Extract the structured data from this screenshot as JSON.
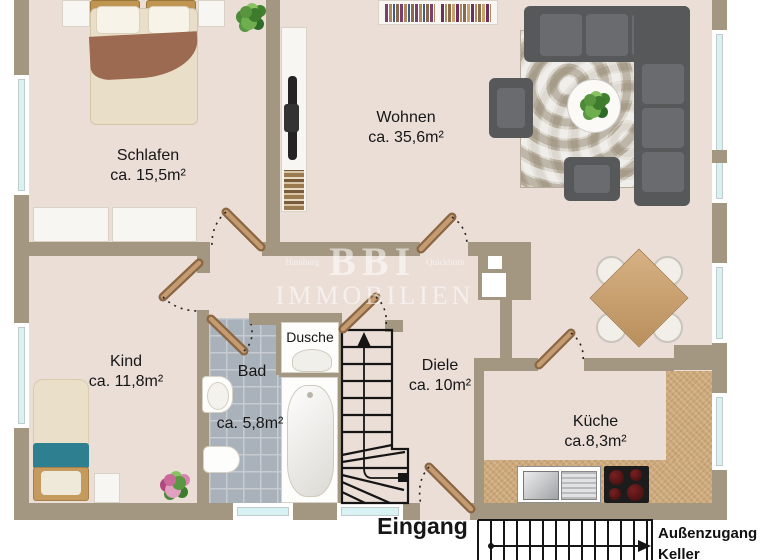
{
  "watermark": {
    "brand": "BBI",
    "brand_sub": "IMMOBILIEN",
    "city_left": "Hamburg",
    "city_right": "Quickborn"
  },
  "rooms": {
    "schlafen": {
      "name": "Schlafen",
      "area": "ca. 15,5m²"
    },
    "wohnen": {
      "name": "Wohnen",
      "area": "ca. 35,6m²"
    },
    "kind": {
      "name": "Kind",
      "area": "ca. 11,8m²"
    },
    "bad": {
      "name": "Bad",
      "area": "ca. 5,8m²"
    },
    "dusche": {
      "name": "Dusche"
    },
    "diele": {
      "name": "Diele",
      "area": "ca. 10m²"
    },
    "kueche": {
      "name": "Küche",
      "area": "ca.8,3m²"
    }
  },
  "labels": {
    "entrance": "Eingang",
    "outside_access_line1": "Außenzugang",
    "outside_access_line2": "Keller"
  },
  "colors": {
    "floor": "#EBDED7",
    "wall": "#A49781",
    "tile": "#A9B1BB",
    "counter": "#CDA97A",
    "sofa": "#57585A",
    "accent_teal": "#2E7F8F",
    "window_glass": "#D8F1F3"
  }
}
